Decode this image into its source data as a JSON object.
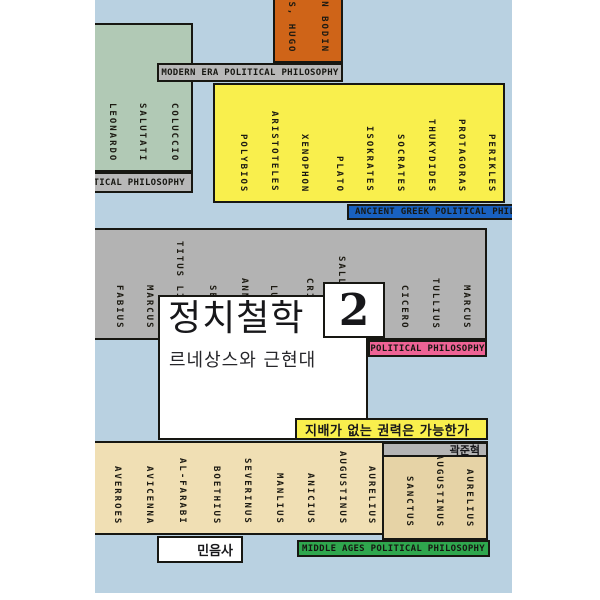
{
  "cover": {
    "title": "정치철학",
    "volume": "2",
    "subtitle": "르네상스와 근현대",
    "tagline": "지배가 없는 권력은 가능한가",
    "author": "곽준혁",
    "publisher": "민음사",
    "colors": {
      "background": "#b9d1e1",
      "renaissance_block": "#b1c9b5",
      "modern_block": "#cf6418",
      "greek_block": "#f9ef4d",
      "greek_tag": "#1961c0",
      "roman_block": "#b3b3b3",
      "roman_tag": "#ee6395",
      "medieval_block": "#f0dfb4",
      "augustine_block": "#e6d3a6",
      "middle_tag": "#2fa74e",
      "tag_gray": "#b8b8b8"
    },
    "tags": {
      "renaissance": "RENAISSANCE POLITICAL PHILOSOPHY",
      "modern": "MODERN ERA POLITICAL PHILOSOPHY",
      "greek": "ANCIENT GREEK POLITICAL PHILOSOPHY",
      "roman": "POLITICAL PHILOSOPHY",
      "middle": "MIDDLE AGES POLITICAL PHILOSOPHY"
    },
    "blocks": {
      "renaissance": {
        "names": [
          "LEONARDO",
          "SALUTATI",
          "COLUCCIO"
        ]
      },
      "modern": {
        "names": [
          "GROTIUS, HUGO",
          "JEAN BODIN"
        ]
      },
      "greek": {
        "names": [
          "POLYBIOS",
          "ARISTOTELES",
          "XENOPHON",
          "PLATO",
          "ISOKRATES",
          "SOCRATES",
          "THUKYDIDES",
          "PROTAGORAS",
          "PERIKLES"
        ]
      },
      "roman": {
        "names": [
          "FABIUS",
          "MARCUS",
          "TITUS LIVIUS",
          "SENECA",
          "ANNAEUS",
          "LUCIUS",
          "CRISPUS",
          "SALLUSTIUS",
          "GAIUS",
          "CICERO",
          "TULLIUS",
          "MARCUS"
        ]
      },
      "medieval": {
        "names": [
          "AVERROES",
          "AVICENNA",
          "AL-FARABI",
          "BOETHIUS",
          "SEVERINUS",
          "MANLIUS",
          "ANICIUS",
          "AUGUSTINUS",
          "AURELIUS"
        ]
      },
      "augustine": {
        "names": [
          "SANCTUS",
          "AUGUSTINUS",
          "AURELIUS"
        ]
      }
    }
  }
}
